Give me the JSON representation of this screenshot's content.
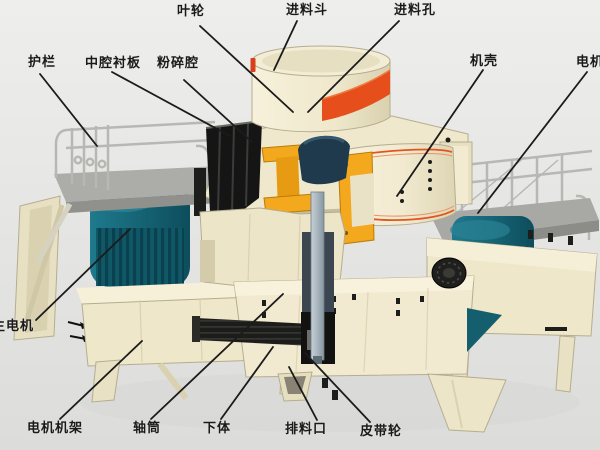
{
  "diagram": {
    "kind": "sand-maker-crusher-structure-cutaway",
    "colors": {
      "background": "#EAEAE8",
      "machine_cream": "#F1EAD0",
      "cream_shade": "#DDD5B2",
      "outline": "#B6AD90",
      "orange_trim": "#E6511D",
      "teal_motor": "#16616F",
      "teal_fin_dark": "#0A4150",
      "impeller_yellow": "#F3A81D",
      "liner_black": "#151515",
      "rotor_navy": "#1F3A4C",
      "platform_grey": "#ACACA9",
      "rail_grey": "#B7B7B3",
      "shaft_grey": "#A9B5BE",
      "belt_black": "#1C1C1A",
      "leader_line": "#1B1B1B",
      "label_text": "#1A1A1A"
    }
  },
  "labels": [
    {
      "name": "impeller",
      "text": "叶轮",
      "lx": 177,
      "ly": 5,
      "line": [
        200,
        26,
        293,
        112
      ]
    },
    {
      "name": "feed-hopper",
      "text": "进料斗",
      "lx": 286,
      "ly": 4,
      "line": [
        297,
        21,
        274,
        70
      ]
    },
    {
      "name": "feed-hole",
      "text": "进料孔",
      "lx": 394,
      "ly": 4,
      "line": [
        399,
        21,
        308,
        112
      ]
    },
    {
      "name": "guardrail",
      "text": "护栏",
      "lx": 28,
      "ly": 56,
      "line": [
        40,
        74,
        97,
        146
      ]
    },
    {
      "name": "middle-cavity-liner",
      "text": "中腔衬板",
      "lx": 85,
      "ly": 57,
      "line": [
        112,
        72,
        230,
        136
      ]
    },
    {
      "name": "crushing-chamber",
      "text": "粉碎腔",
      "lx": 157,
      "ly": 57,
      "line": [
        184,
        80,
        252,
        142
      ]
    },
    {
      "name": "casing",
      "text": "机壳",
      "lx": 470,
      "ly": 55,
      "line": [
        483,
        70,
        397,
        196
      ]
    },
    {
      "name": "motor",
      "text": "电机",
      "lx": 576,
      "ly": 56,
      "line": [
        587,
        72,
        478,
        213
      ]
    },
    {
      "name": "main-motor",
      "text": "主电机",
      "lx": -8,
      "ly": 320,
      "line": [
        36,
        320,
        130,
        229
      ]
    },
    {
      "name": "motor-frame",
      "text": "电机机架",
      "lx": 27,
      "ly": 422,
      "line": [
        60,
        419,
        142,
        341
      ]
    },
    {
      "name": "shaft-tube",
      "text": "轴筒",
      "lx": 133,
      "ly": 422,
      "line": [
        151,
        419,
        283,
        294
      ]
    },
    {
      "name": "lower-body",
      "text": "下体",
      "lx": 203,
      "ly": 422,
      "line": [
        221,
        419,
        273,
        347
      ]
    },
    {
      "name": "discharge-port",
      "text": "排料口",
      "lx": 285,
      "ly": 423,
      "line": [
        317,
        420,
        289,
        367
      ]
    },
    {
      "name": "belt-pulley",
      "text": "皮带轮",
      "lx": 360,
      "ly": 425,
      "line": [
        370,
        422,
        305,
        353
      ]
    }
  ]
}
